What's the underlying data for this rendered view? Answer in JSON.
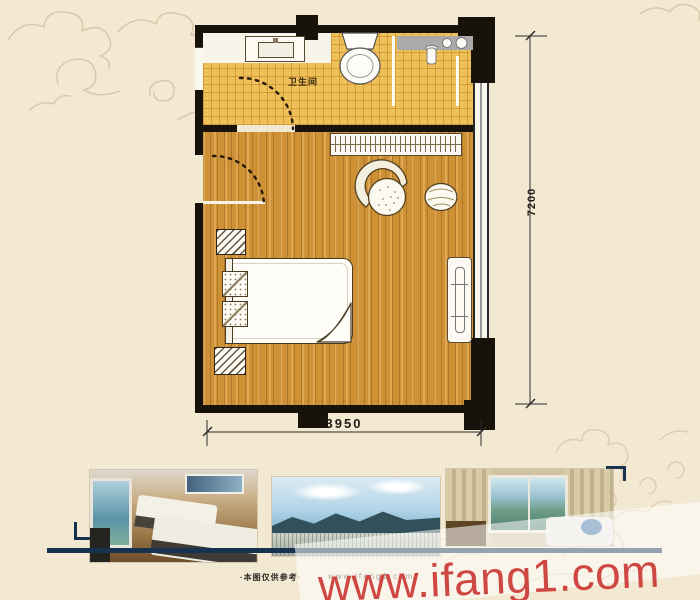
{
  "plan": {
    "bathroom_label": "卫生间",
    "dim_vertical": "7200",
    "dim_horizontal": "3950"
  },
  "footer": {
    "disclaimer": "·本图仅供参考·",
    "watermark_small": "www.ifang1.com"
  },
  "watermark": {
    "text": "www.ifang1.com",
    "color": "#cf4742"
  },
  "photos": [
    {
      "alt": "twin-bed hotel guest room photo"
    },
    {
      "alt": "mountain and city panorama photo"
    },
    {
      "alt": "guest room window with mountain view photo"
    }
  ],
  "colors": {
    "background": "#f3e8d2",
    "wall": "#17120a",
    "tile_floor": "#eec05a",
    "wood_floor": "#cf9135",
    "accent_navy": "#16324f",
    "watermark_red": "#cf4742"
  }
}
